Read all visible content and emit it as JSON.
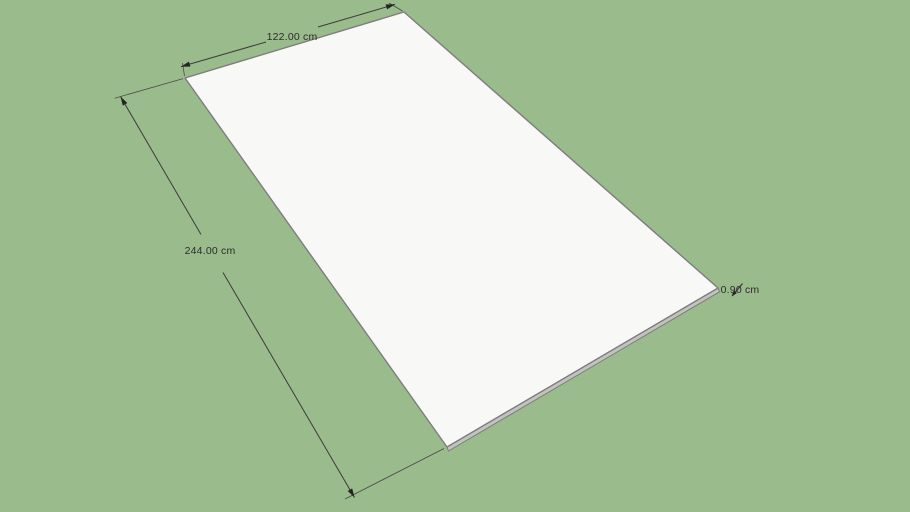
{
  "viewport": {
    "model": {
      "name": "panel-sheet"
    },
    "dimensions": {
      "width_label": "122.00 cm",
      "length_label": "244.00 cm",
      "thickness_label": "0.90 cm"
    },
    "colors": {
      "background": "#9ABB8C",
      "panel_face": "#F8F8F7",
      "panel_side": "#C2C2BF",
      "edge": "#7D7D7D",
      "dimension_line": "#3C3C3C",
      "dimension_text": "#2C2C2C"
    }
  }
}
